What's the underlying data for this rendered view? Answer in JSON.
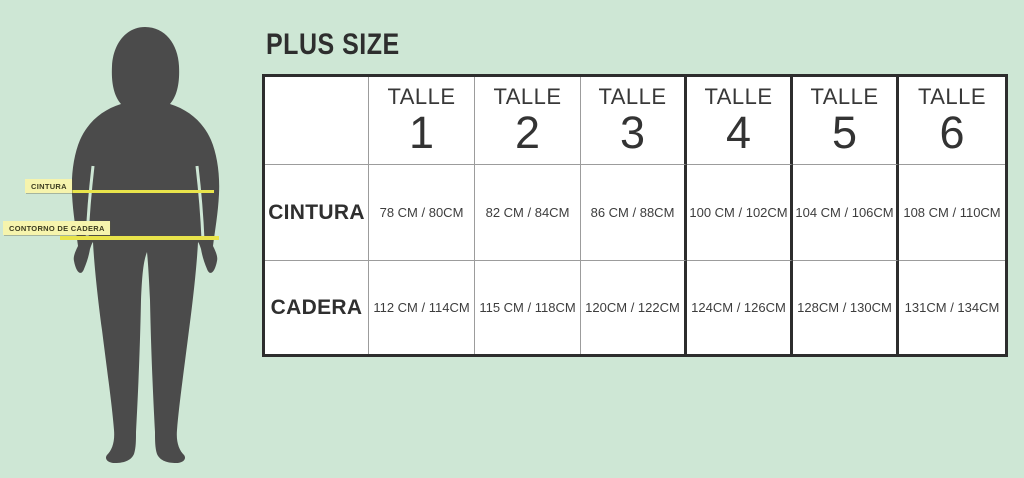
{
  "title": "PLUS SIZE",
  "figure": {
    "waist_label": "CINTURA",
    "hip_label": "CONTORNO DE CADERA"
  },
  "colors": {
    "background": "#cee7d5",
    "silhouette": "#4b4b4b",
    "measure_line": "#e9e44b",
    "measure_label_bg": "#f6f4ad",
    "table_border_dark": "#2d2d2d",
    "table_border_light": "#9c9c9c"
  },
  "table": {
    "size_word": "TALLE",
    "sizes": [
      "1",
      "2",
      "3",
      "4",
      "5",
      "6"
    ],
    "rows": [
      {
        "label": "CINTURA",
        "values": [
          "78 CM / 80CM",
          "82 CM / 84CM",
          "86 CM / 88CM",
          "100 CM / 102CM",
          "104 CM / 106CM",
          "108 CM / 110CM"
        ]
      },
      {
        "label": "CADERA",
        "values": [
          "112 CM / 114CM",
          "115 CM / 118CM",
          "120CM / 122CM",
          "124CM / 126CM",
          "128CM / 130CM",
          "131CM / 134CM"
        ]
      }
    ]
  }
}
